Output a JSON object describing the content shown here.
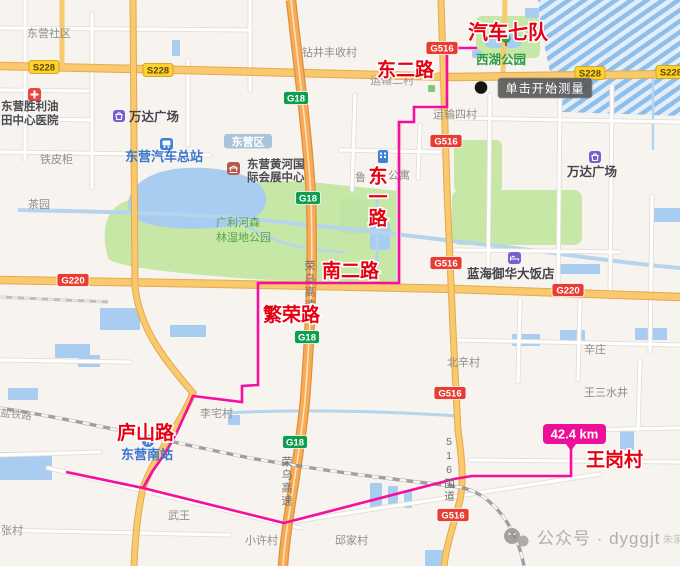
{
  "map": {
    "tooltip": "单击开始测量",
    "distance": "42.4 km",
    "watermark": "公众号 · dyggjt",
    "route": {
      "start_label": "汽车七队",
      "end_label": "王岗村",
      "road_dong_er": "东二路",
      "road_dong_yi": "东一路",
      "road_nan_er": "南二路",
      "road_fan_rong": "繁荣路",
      "road_lu_shan": "庐山路"
    },
    "badges": {
      "s228": "S228",
      "g18": "G18",
      "g220": "G220",
      "g516": "G516"
    },
    "district_badge": "东营区",
    "places": {
      "dongying_shequ": "东营社区",
      "zuanjing_village": "钻井丰收村",
      "xihu_park": "西湖公园",
      "wanda_plaza_west": "万达广场",
      "wanda_plaza_east": "万达广场",
      "bus_station": "东营汽车总站",
      "tiepigui": "铁皮柜",
      "hospital_line1": "东营胜利油",
      "hospital_line2": "田中心医院",
      "chayuan": "茶园",
      "convention_line1": "东营黄河国",
      "convention_line2": "际会展中心",
      "yunshu_er_village": "运输二村",
      "yunshu_si_village": "运输四村",
      "apartment_part1": "鲁",
      "apartment_part2": "公寓",
      "wetland_park_line1": "广利河森",
      "wetland_park_line2": "林湿地公园",
      "lanhai_hotel": "蓝海御华大饭店",
      "xinzhuang": "辛庄",
      "beixin_village": "北辛村",
      "wangsan_shuijing": "王三水井",
      "lizhai_village": "李宅村",
      "south_station": "东营南站",
      "wuwang": "武王",
      "zhang_village": "东张村",
      "xiaoxu_village": "小许村",
      "qiujia_village": "邱家村",
      "zhujia": "朱家"
    },
    "road_names": {
      "rongwu_expressway": "荣乌高速",
      "g516_national_road": "516国道",
      "railway": "盐铁路"
    },
    "colors": {
      "route": "#f50f9e",
      "measure_badge": "#ee0f99",
      "badge_red": "#e63e32",
      "badge_green": "#0f9d4f",
      "badge_yellow": "#ffd12e",
      "park_green": "#c6e7a5",
      "water_blue": "#a8cdf0",
      "road_orange": "#f8c96d"
    }
  }
}
